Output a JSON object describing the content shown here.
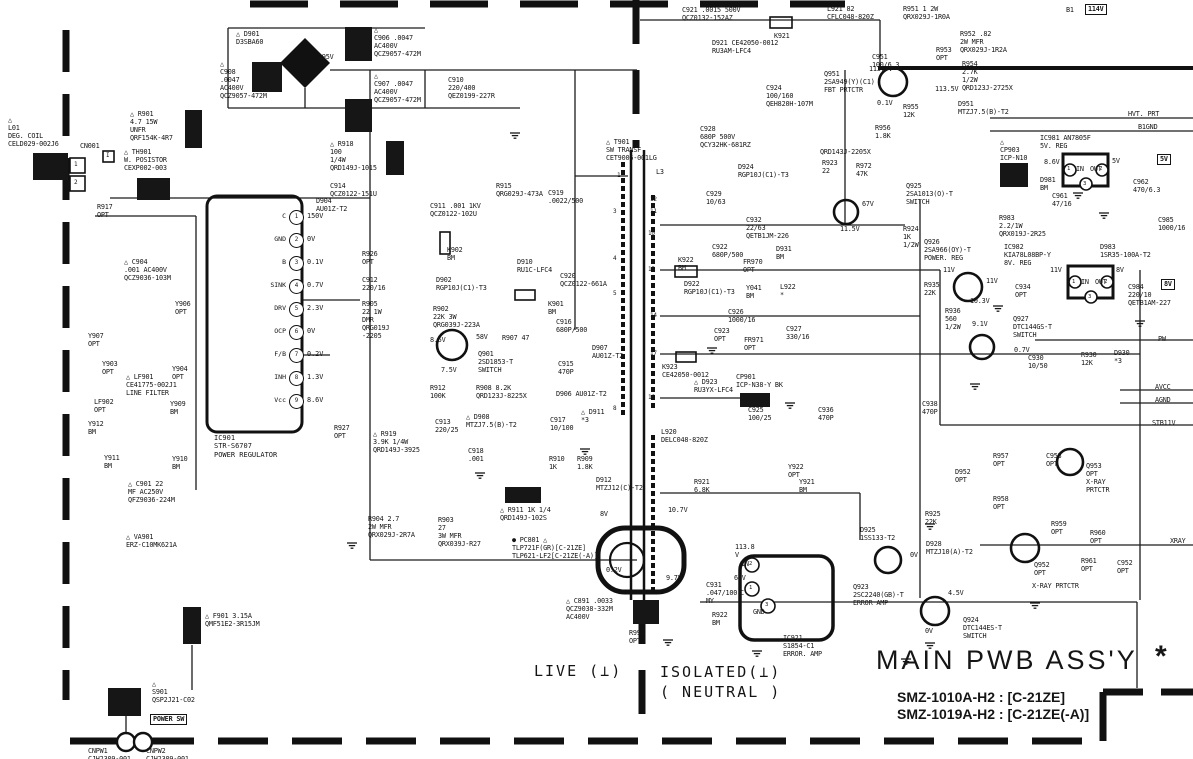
{
  "page": {
    "title": "MAIN PWB ASS'Y",
    "star": "*",
    "models": [
      "SMZ-1010A-H2 : [C-21ZE]",
      "SMZ-1019A-H2 : [C-21ZE(-A)]"
    ],
    "live": "LIVE (⊥)",
    "isolated": "ISOLATED(⊥)\n( NEUTRAL )"
  },
  "colors": {
    "ink": "#161616",
    "paper": "#ffffff"
  },
  "ic901": {
    "ref": "IC901",
    "part": "STR-S6707",
    "role": "POWER REGULATOR",
    "pins": [
      {
        "n": 1,
        "name": "C",
        "v": "150V",
        "y": 217
      },
      {
        "n": 2,
        "name": "GND",
        "v": "0V",
        "y": 240
      },
      {
        "n": 3,
        "name": "B",
        "v": "0.1V",
        "y": 263
      },
      {
        "n": 4,
        "name": "SINK",
        "v": "0.7V",
        "y": 286
      },
      {
        "n": 5,
        "name": "DRV",
        "v": "2.3V",
        "y": 309
      },
      {
        "n": 6,
        "name": "OCP",
        "v": "0V",
        "y": 332
      },
      {
        "n": 7,
        "name": "F/B",
        "v": "0.2V",
        "y": 355
      },
      {
        "n": 8,
        "name": "INH",
        "v": "1.3V",
        "y": 378
      },
      {
        "n": 9,
        "name": "Vcc",
        "v": "8.6V",
        "y": 401
      }
    ]
  },
  "badges": [
    {
      "t": "114V",
      "x": 1085,
      "y": 4
    },
    {
      "t": "5V",
      "x": 1157,
      "y": 154
    },
    {
      "t": "8V",
      "x": 1161,
      "y": 279
    },
    {
      "t": "POWER SW",
      "x": 150,
      "y": 714
    }
  ],
  "labels": [
    {
      "t": "△ D901\nD3SBA60",
      "x": 236,
      "y": 30
    },
    {
      "t": "△\nC906 .0047\nAC400V\nQCZ9057-472M",
      "x": 374,
      "y": 26
    },
    {
      "t": "295V",
      "x": 318,
      "y": 53
    },
    {
      "t": "△\nC908\n.0047\nAC400V\nQCZ9057-472M",
      "x": 220,
      "y": 60
    },
    {
      "t": "△\nC907 .0047\nAC400V\nQCZ9057-472M",
      "x": 374,
      "y": 72
    },
    {
      "t": "C910\n220/400\nQEZ0199-227R",
      "x": 448,
      "y": 76
    },
    {
      "t": "△\nL01\nDEG. COIL\nCELD029-002J6",
      "x": 8,
      "y": 116
    },
    {
      "t": "CN001",
      "x": 80,
      "y": 142
    },
    {
      "t": "I",
      "x": 106,
      "y": 152,
      "fs": 6
    },
    {
      "t": "1",
      "x": 74,
      "y": 161,
      "fs": 6
    },
    {
      "t": "2",
      "x": 74,
      "y": 179,
      "fs": 6
    },
    {
      "t": "△ R901\n4.7 15W\nUNFR\nQRF154K-4R7",
      "x": 130,
      "y": 110
    },
    {
      "t": "△ TH901\nW. POSISTOR\nCEXP002-003",
      "x": 124,
      "y": 148
    },
    {
      "t": "△ R918\n100\n1/4W\nQRD149J-1015",
      "x": 330,
      "y": 140
    },
    {
      "t": "C914\nQCZ0122-151U",
      "x": 330,
      "y": 182
    },
    {
      "t": "R917\nOPT",
      "x": 97,
      "y": 203
    },
    {
      "t": "△ C904\n.001 AC400V\nQCZ9036-103M",
      "x": 124,
      "y": 258
    },
    {
      "t": "Y907\nOPT",
      "x": 88,
      "y": 332
    },
    {
      "t": "Y903\nOPT",
      "x": 102,
      "y": 360
    },
    {
      "t": "Y906\nOPT",
      "x": 175,
      "y": 300
    },
    {
      "t": "Y904\nOPT",
      "x": 172,
      "y": 365
    },
    {
      "t": "△ LF901\nCE41775-002J1\nLINE FILTER",
      "x": 126,
      "y": 373
    },
    {
      "t": "LF902\nOPT",
      "x": 94,
      "y": 398
    },
    {
      "t": "Y912\nBM",
      "x": 88,
      "y": 420
    },
    {
      "t": "Y911\nBM",
      "x": 104,
      "y": 454
    },
    {
      "t": "Y909\nBM",
      "x": 170,
      "y": 400
    },
    {
      "t": "Y910\nBM",
      "x": 172,
      "y": 455
    },
    {
      "t": "△ C901 22\nMF AC250V\nQFZ9036-224M",
      "x": 128,
      "y": 480
    },
    {
      "t": "△ VA901\nERZ-C10MK621A",
      "x": 126,
      "y": 533
    },
    {
      "t": "△ F901 3.15A\nQMF51E2-3R15JM",
      "x": 205,
      "y": 612
    },
    {
      "t": "△\nS901\nQSP2J21-C02",
      "x": 152,
      "y": 680
    },
    {
      "t": "CNPW1\nCJH2309-001",
      "x": 88,
      "y": 747
    },
    {
      "t": "CNPW2\nCJH2309-001",
      "x": 146,
      "y": 747
    },
    {
      "t": "D904\nAU01Z-T2",
      "x": 316,
      "y": 197
    },
    {
      "t": "R926\nOPT",
      "x": 362,
      "y": 250
    },
    {
      "t": "C912\n220/16",
      "x": 362,
      "y": 276
    },
    {
      "t": "R905\n22 1W\nDMR\nQRG019J\n-2205",
      "x": 362,
      "y": 300
    },
    {
      "t": "R927\nOPT",
      "x": 334,
      "y": 424
    },
    {
      "t": "△ R919\n3.9K 1/4W\nQRD149J-3925",
      "x": 373,
      "y": 430
    },
    {
      "t": "C911 .001 1KV\nQCZ0122-102U",
      "x": 430,
      "y": 202
    },
    {
      "t": "K902\nBM",
      "x": 447,
      "y": 246
    },
    {
      "t": "D902\nRGP10J(C1)-T3",
      "x": 436,
      "y": 276
    },
    {
      "t": "R902\n22K 3W\nQRG039J-223A",
      "x": 433,
      "y": 305
    },
    {
      "t": "D910\nRU1C-LFC4",
      "x": 517,
      "y": 258
    },
    {
      "t": "C920\nQCZ0122-661A",
      "x": 560,
      "y": 272
    },
    {
      "t": "K901\nBM",
      "x": 548,
      "y": 300
    },
    {
      "t": "8.5V",
      "x": 430,
      "y": 336
    },
    {
      "t": "58V",
      "x": 476,
      "y": 333
    },
    {
      "t": "R907 47",
      "x": 502,
      "y": 334
    },
    {
      "t": "Q901\n2SD1853-T\nSWITCH",
      "x": 478,
      "y": 350
    },
    {
      "t": "7.5V",
      "x": 441,
      "y": 366
    },
    {
      "t": "R912\n100K",
      "x": 430,
      "y": 384
    },
    {
      "t": "R908 8.2K\nQRD123J-8225X",
      "x": 476,
      "y": 384
    },
    {
      "t": "C916\n680P/500",
      "x": 556,
      "y": 318
    },
    {
      "t": "D907\nAU01Z-T2",
      "x": 592,
      "y": 344
    },
    {
      "t": "C915\n470P",
      "x": 558,
      "y": 360
    },
    {
      "t": "D906 AU01Z-T2",
      "x": 556,
      "y": 390
    },
    {
      "t": "△ D911\n*3",
      "x": 581,
      "y": 408
    },
    {
      "t": "C913\n220/25",
      "x": 435,
      "y": 418
    },
    {
      "t": "△ D908\nMTZJ7.5(B)-T2",
      "x": 466,
      "y": 413
    },
    {
      "t": "C918\n.001",
      "x": 468,
      "y": 447
    },
    {
      "t": "C917\n10/100",
      "x": 550,
      "y": 416
    },
    {
      "t": "R910\n1K",
      "x": 549,
      "y": 455
    },
    {
      "t": "R909\n1.8K",
      "x": 577,
      "y": 455
    },
    {
      "t": "R904 2.7\n2W MFR\nQRX029J-2R7A",
      "x": 368,
      "y": 515
    },
    {
      "t": "R903\n27\n3W MFR\nQRX039J-R27",
      "x": 438,
      "y": 516
    },
    {
      "t": "△ R911 1K 1/4\nQRD149J-102S",
      "x": 500,
      "y": 506
    },
    {
      "t": "● PC801 △\nTLP721F(GR)[C-21ZE]\nTLP621-LF2[C-21ZE(-A)]",
      "x": 512,
      "y": 536
    },
    {
      "t": "0.2V",
      "x": 606,
      "y": 566
    },
    {
      "t": "9.7V",
      "x": 666,
      "y": 574
    },
    {
      "t": "8V",
      "x": 600,
      "y": 510
    },
    {
      "t": "10.7V",
      "x": 668,
      "y": 506
    },
    {
      "t": "△ C891 .0033\nQCZ9038-332M\nAC400V",
      "x": 566,
      "y": 597
    },
    {
      "t": "R991\nOPT",
      "x": 629,
      "y": 629
    },
    {
      "t": "C931\n.047/100\nMY",
      "x": 706,
      "y": 581
    },
    {
      "t": "R922\nBM",
      "x": 712,
      "y": 611
    },
    {
      "t": "IC921\nS1854-C1\nERROR. AMP",
      "x": 783,
      "y": 634
    },
    {
      "t": "2",
      "x": 749,
      "y": 561,
      "fs": 5.5
    },
    {
      "t": "1",
      "x": 749,
      "y": 585,
      "fs": 5.5
    },
    {
      "t": "3",
      "x": 765,
      "y": 602,
      "fs": 5.5
    },
    {
      "t": "IN",
      "x": 741,
      "y": 560
    },
    {
      "t": "113.8\nV",
      "x": 735,
      "y": 543
    },
    {
      "t": "64V",
      "x": 734,
      "y": 574
    },
    {
      "t": "C",
      "x": 740,
      "y": 589
    },
    {
      "t": "GND",
      "x": 753,
      "y": 608
    },
    {
      "t": "△ T901\nSW TRANSF\nCET9006-001LG",
      "x": 606,
      "y": 138
    },
    {
      "t": "L3",
      "x": 656,
      "y": 168
    },
    {
      "t": "1",
      "x": 617,
      "y": 172,
      "fs": 6
    },
    {
      "t": "3",
      "x": 613,
      "y": 208,
      "fs": 6
    },
    {
      "t": "4",
      "x": 613,
      "y": 255,
      "fs": 6
    },
    {
      "t": "5",
      "x": 613,
      "y": 290,
      "fs": 6
    },
    {
      "t": "8",
      "x": 613,
      "y": 405,
      "fs": 6
    },
    {
      "t": "12",
      "x": 650,
      "y": 196,
      "fs": 6
    },
    {
      "t": "11",
      "x": 650,
      "y": 208,
      "fs": 6
    },
    {
      "t": "10",
      "x": 648,
      "y": 230,
      "fs": 6
    },
    {
      "t": "15",
      "x": 648,
      "y": 266,
      "fs": 6
    },
    {
      "t": "14",
      "x": 650,
      "y": 312,
      "fs": 6
    },
    {
      "t": "17",
      "x": 650,
      "y": 350,
      "fs": 6
    },
    {
      "t": "16",
      "x": 648,
      "y": 394,
      "fs": 6
    },
    {
      "t": "C921 .0015 500V\nQCZ0132-152AZ",
      "x": 682,
      "y": 6
    },
    {
      "t": "K921",
      "x": 774,
      "y": 32
    },
    {
      "t": "D921 CE42050-0012\nRU3AM-LFC4",
      "x": 712,
      "y": 39
    },
    {
      "t": "L921 82\nCFLC048-820Z",
      "x": 827,
      "y": 5
    },
    {
      "t": "C924\n100/160\nQEH820H-107M",
      "x": 766,
      "y": 84
    },
    {
      "t": "C928\n680P 500V\nQCY32HK-681RZ",
      "x": 700,
      "y": 125
    },
    {
      "t": "D924\nRGP10J(C1)-T3",
      "x": 738,
      "y": 163
    },
    {
      "t": "C929\n10/63",
      "x": 706,
      "y": 190
    },
    {
      "t": "C932\n22/63\nQETB1JM-226",
      "x": 746,
      "y": 216
    },
    {
      "t": "R915\nQRG029J-473A",
      "x": 496,
      "y": 182
    },
    {
      "t": "C919\n.0022/500",
      "x": 548,
      "y": 189
    },
    {
      "t": "QRD143J-2205X",
      "x": 820,
      "y": 148
    },
    {
      "t": "R923\n22",
      "x": 822,
      "y": 159
    },
    {
      "t": "R972\n47K",
      "x": 856,
      "y": 162
    },
    {
      "t": "67V",
      "x": 862,
      "y": 200
    },
    {
      "t": "11.5V",
      "x": 840,
      "y": 225
    },
    {
      "t": "C922\n680P/500",
      "x": 712,
      "y": 243
    },
    {
      "t": "K922\nBM",
      "x": 678,
      "y": 256
    },
    {
      "t": "FR970\nOPT",
      "x": 743,
      "y": 258
    },
    {
      "t": "D931\nBM",
      "x": 776,
      "y": 245
    },
    {
      "t": "D922\nRGP10J(C1)-T3",
      "x": 684,
      "y": 280
    },
    {
      "t": "Y041\nBM",
      "x": 746,
      "y": 284
    },
    {
      "t": "L922\n*",
      "x": 780,
      "y": 283
    },
    {
      "t": "C926\n1000/16",
      "x": 728,
      "y": 308
    },
    {
      "t": "C927\n330/16",
      "x": 786,
      "y": 325
    },
    {
      "t": "C923\nOPT",
      "x": 714,
      "y": 327
    },
    {
      "t": "FR971\nOPT",
      "x": 744,
      "y": 336
    },
    {
      "t": "K923\nCE42050-0012",
      "x": 662,
      "y": 363
    },
    {
      "t": "△ D923\nRU3YX-LFC4",
      "x": 694,
      "y": 378
    },
    {
      "t": "CP901\nICP-N38-Y BK",
      "x": 736,
      "y": 373
    },
    {
      "t": "L920\nDELC048-820Z",
      "x": 661,
      "y": 428
    },
    {
      "t": "C925\n100/25",
      "x": 748,
      "y": 406
    },
    {
      "t": "C936\n470P",
      "x": 818,
      "y": 406
    },
    {
      "t": "C938\n470P",
      "x": 922,
      "y": 400
    },
    {
      "t": "Y922\nOPT",
      "x": 788,
      "y": 463
    },
    {
      "t": "Y921\nBM",
      "x": 799,
      "y": 478
    },
    {
      "t": "R921\n6.8K",
      "x": 694,
      "y": 478
    },
    {
      "t": "D912\nMTZJ12(C)-T2",
      "x": 596,
      "y": 476
    },
    {
      "t": "D925\n1SS133-T2",
      "x": 860,
      "y": 526
    },
    {
      "t": "Q923\n2SC2240(GB)-T\nERROR AMP",
      "x": 853,
      "y": 583
    },
    {
      "t": "Q924\nDTC144ES-T\nSWITCH",
      "x": 963,
      "y": 616
    },
    {
      "t": "4.5V",
      "x": 948,
      "y": 589
    },
    {
      "t": "0V",
      "x": 925,
      "y": 627
    },
    {
      "t": "D928\nMTZJ10(A)-T2",
      "x": 926,
      "y": 540
    },
    {
      "t": "0V",
      "x": 910,
      "y": 551
    },
    {
      "t": "R951 1 2W\nQRX029J-1R0A",
      "x": 903,
      "y": 5
    },
    {
      "t": "B1",
      "x": 1066,
      "y": 6
    },
    {
      "t": "R952 .82\n2W MFR\nQRX029J-1R2A",
      "x": 960,
      "y": 30
    },
    {
      "t": "R953\nOPT",
      "x": 936,
      "y": 46
    },
    {
      "t": "R954\n2.7K\n1/2W\nQRD123J-2725X",
      "x": 962,
      "y": 60
    },
    {
      "t": "113.5V",
      "x": 935,
      "y": 85
    },
    {
      "t": "R955\n12K",
      "x": 903,
      "y": 103
    },
    {
      "t": "D951\nMTZJ7.5(B)-T2",
      "x": 958,
      "y": 100
    },
    {
      "t": "HVT. PRT",
      "x": 1128,
      "y": 110
    },
    {
      "t": "B1GND",
      "x": 1138,
      "y": 123
    },
    {
      "t": "C951\n100/6.3",
      "x": 872,
      "y": 53
    },
    {
      "t": "113.7V",
      "x": 869,
      "y": 65
    },
    {
      "t": "Q951\n2SA949(Y)(C1)\nFBT PRTCTR",
      "x": 824,
      "y": 70
    },
    {
      "t": "0.1V",
      "x": 877,
      "y": 99
    },
    {
      "t": "R956\n1.8K",
      "x": 875,
      "y": 124
    },
    {
      "t": "△\nCP903\nICP-N10",
      "x": 1000,
      "y": 138
    },
    {
      "t": "IC981 AN7805F\n5V. REG",
      "x": 1040,
      "y": 134
    },
    {
      "t": "8.6V",
      "x": 1044,
      "y": 158
    },
    {
      "t": "D981\nBM",
      "x": 1040,
      "y": 176
    },
    {
      "t": "C961\n47/16",
      "x": 1052,
      "y": 192
    },
    {
      "t": "5V",
      "x": 1112,
      "y": 157
    },
    {
      "t": "C962\n470/6.3",
      "x": 1133,
      "y": 178
    },
    {
      "t": "Q925\n2SA1013(O)-T\nSWITCH",
      "x": 906,
      "y": 182
    },
    {
      "t": "R924\n1K\n1/2W",
      "x": 903,
      "y": 225
    },
    {
      "t": "R983\n2.2/1W\nQRX019J-2R25",
      "x": 999,
      "y": 214
    },
    {
      "t": "C985\n1000/16",
      "x": 1158,
      "y": 216
    },
    {
      "t": "IC982\nKIA78L08BP-Y\n8V. REG",
      "x": 1004,
      "y": 243
    },
    {
      "t": "D983\n1SR35-100A-T2",
      "x": 1100,
      "y": 243
    },
    {
      "t": "Q926\n2SA966(OY)-T\nPOWER. REG",
      "x": 924,
      "y": 238
    },
    {
      "t": "11V",
      "x": 943,
      "y": 266
    },
    {
      "t": "11V",
      "x": 986,
      "y": 277
    },
    {
      "t": "11V",
      "x": 1050,
      "y": 266
    },
    {
      "t": "8V",
      "x": 1116,
      "y": 266
    },
    {
      "t": "IN",
      "x": 1076,
      "y": 165
    },
    {
      "t": "OUT",
      "x": 1090,
      "y": 165
    },
    {
      "t": "1",
      "x": 1067,
      "y": 166,
      "fs": 5.5
    },
    {
      "t": "2",
      "x": 1099,
      "y": 166,
      "fs": 5.5
    },
    {
      "t": "3",
      "x": 1083,
      "y": 181,
      "fs": 5.5
    },
    {
      "t": "IN",
      "x": 1081,
      "y": 278
    },
    {
      "t": "OUT",
      "x": 1095,
      "y": 278
    },
    {
      "t": "1",
      "x": 1072,
      "y": 279,
      "fs": 5.5
    },
    {
      "t": "2",
      "x": 1104,
      "y": 279,
      "fs": 5.5
    },
    {
      "t": "3",
      "x": 1088,
      "y": 294,
      "fs": 5.5
    },
    {
      "t": "R935\n22K",
      "x": 924,
      "y": 281
    },
    {
      "t": "10.3V",
      "x": 970,
      "y": 297
    },
    {
      "t": "R936\n560\n1/2W",
      "x": 945,
      "y": 307
    },
    {
      "t": "C934\nOPT",
      "x": 1015,
      "y": 283
    },
    {
      "t": "C984\n220/10\nQETB1AM-227",
      "x": 1128,
      "y": 283
    },
    {
      "t": "9.1V",
      "x": 972,
      "y": 320
    },
    {
      "t": "Q927\nDTC144GS-T\nSWITCH",
      "x": 1013,
      "y": 315
    },
    {
      "t": "0.7V",
      "x": 1014,
      "y": 346
    },
    {
      "t": "C930\n10/50",
      "x": 1028,
      "y": 354
    },
    {
      "t": "R930\n12K",
      "x": 1081,
      "y": 351
    },
    {
      "t": "D930\n*3",
      "x": 1114,
      "y": 349
    },
    {
      "t": "PW",
      "x": 1158,
      "y": 335
    },
    {
      "t": "AVCC",
      "x": 1155,
      "y": 383
    },
    {
      "t": "AGND",
      "x": 1155,
      "y": 396
    },
    {
      "t": "STB11V",
      "x": 1152,
      "y": 419
    },
    {
      "t": "R957\nOPT",
      "x": 993,
      "y": 452
    },
    {
      "t": "C953\nOPT",
      "x": 1046,
      "y": 452
    },
    {
      "t": "Q953\nOPT\nX-RAY\nPRTCTR",
      "x": 1086,
      "y": 462
    },
    {
      "t": "D952\nOPT",
      "x": 955,
      "y": 468
    },
    {
      "t": "R958\nOPT",
      "x": 993,
      "y": 495
    },
    {
      "t": "R925\n22K",
      "x": 925,
      "y": 510
    },
    {
      "t": "R959\nOPT",
      "x": 1051,
      "y": 520
    },
    {
      "t": "R960\nOPT",
      "x": 1090,
      "y": 529
    },
    {
      "t": "XRAY",
      "x": 1170,
      "y": 537
    },
    {
      "t": "R961\nOPT",
      "x": 1081,
      "y": 557
    },
    {
      "t": "C952\nOPT",
      "x": 1117,
      "y": 559
    },
    {
      "t": "Q952\nOPT",
      "x": 1034,
      "y": 561
    },
    {
      "t": "X-RAY PRTCTR",
      "x": 1032,
      "y": 582
    }
  ]
}
